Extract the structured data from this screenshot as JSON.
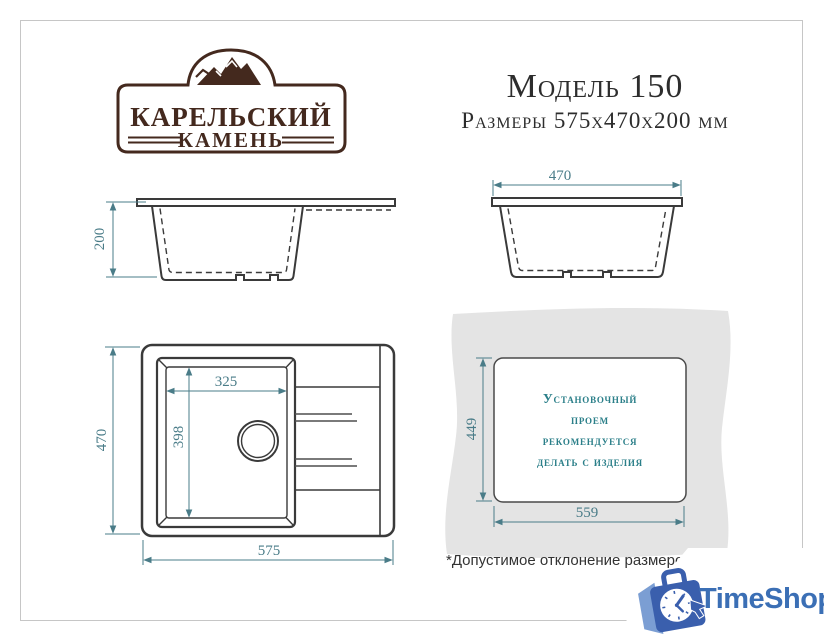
{
  "brand": {
    "line1": "КАРЕЛЬСКИЙ",
    "line2": "КАМЕНЬ"
  },
  "header": {
    "model": "Модель 150",
    "dimensions": "Размеры 575х470х200 мм"
  },
  "drawings": {
    "front_view": {
      "height_label": "200"
    },
    "side_view": {
      "width_label": "470"
    },
    "top_view": {
      "depth_label": "470",
      "length_label": "575",
      "bowl_width_label": "325",
      "bowl_depth_label": "398"
    },
    "cutout": {
      "height_label": "449",
      "width_label": "559",
      "note_lines": [
        "Установочный",
        "проем",
        "рекомендуется",
        "делать с изделия"
      ]
    }
  },
  "footnote": {
    "text": "*Допустимое отклонение размеров ± 5мм"
  },
  "watermark": {
    "text": "TimeShop"
  },
  "colors": {
    "brand_brown": "#44291e",
    "dimension_teal": "#4a7c88",
    "note_teal": "#2b7f89",
    "drawing_line": "#3a3a3a",
    "countertop_gray": "#e4e4e4",
    "watermark_blue": "#3b6fb5"
  }
}
